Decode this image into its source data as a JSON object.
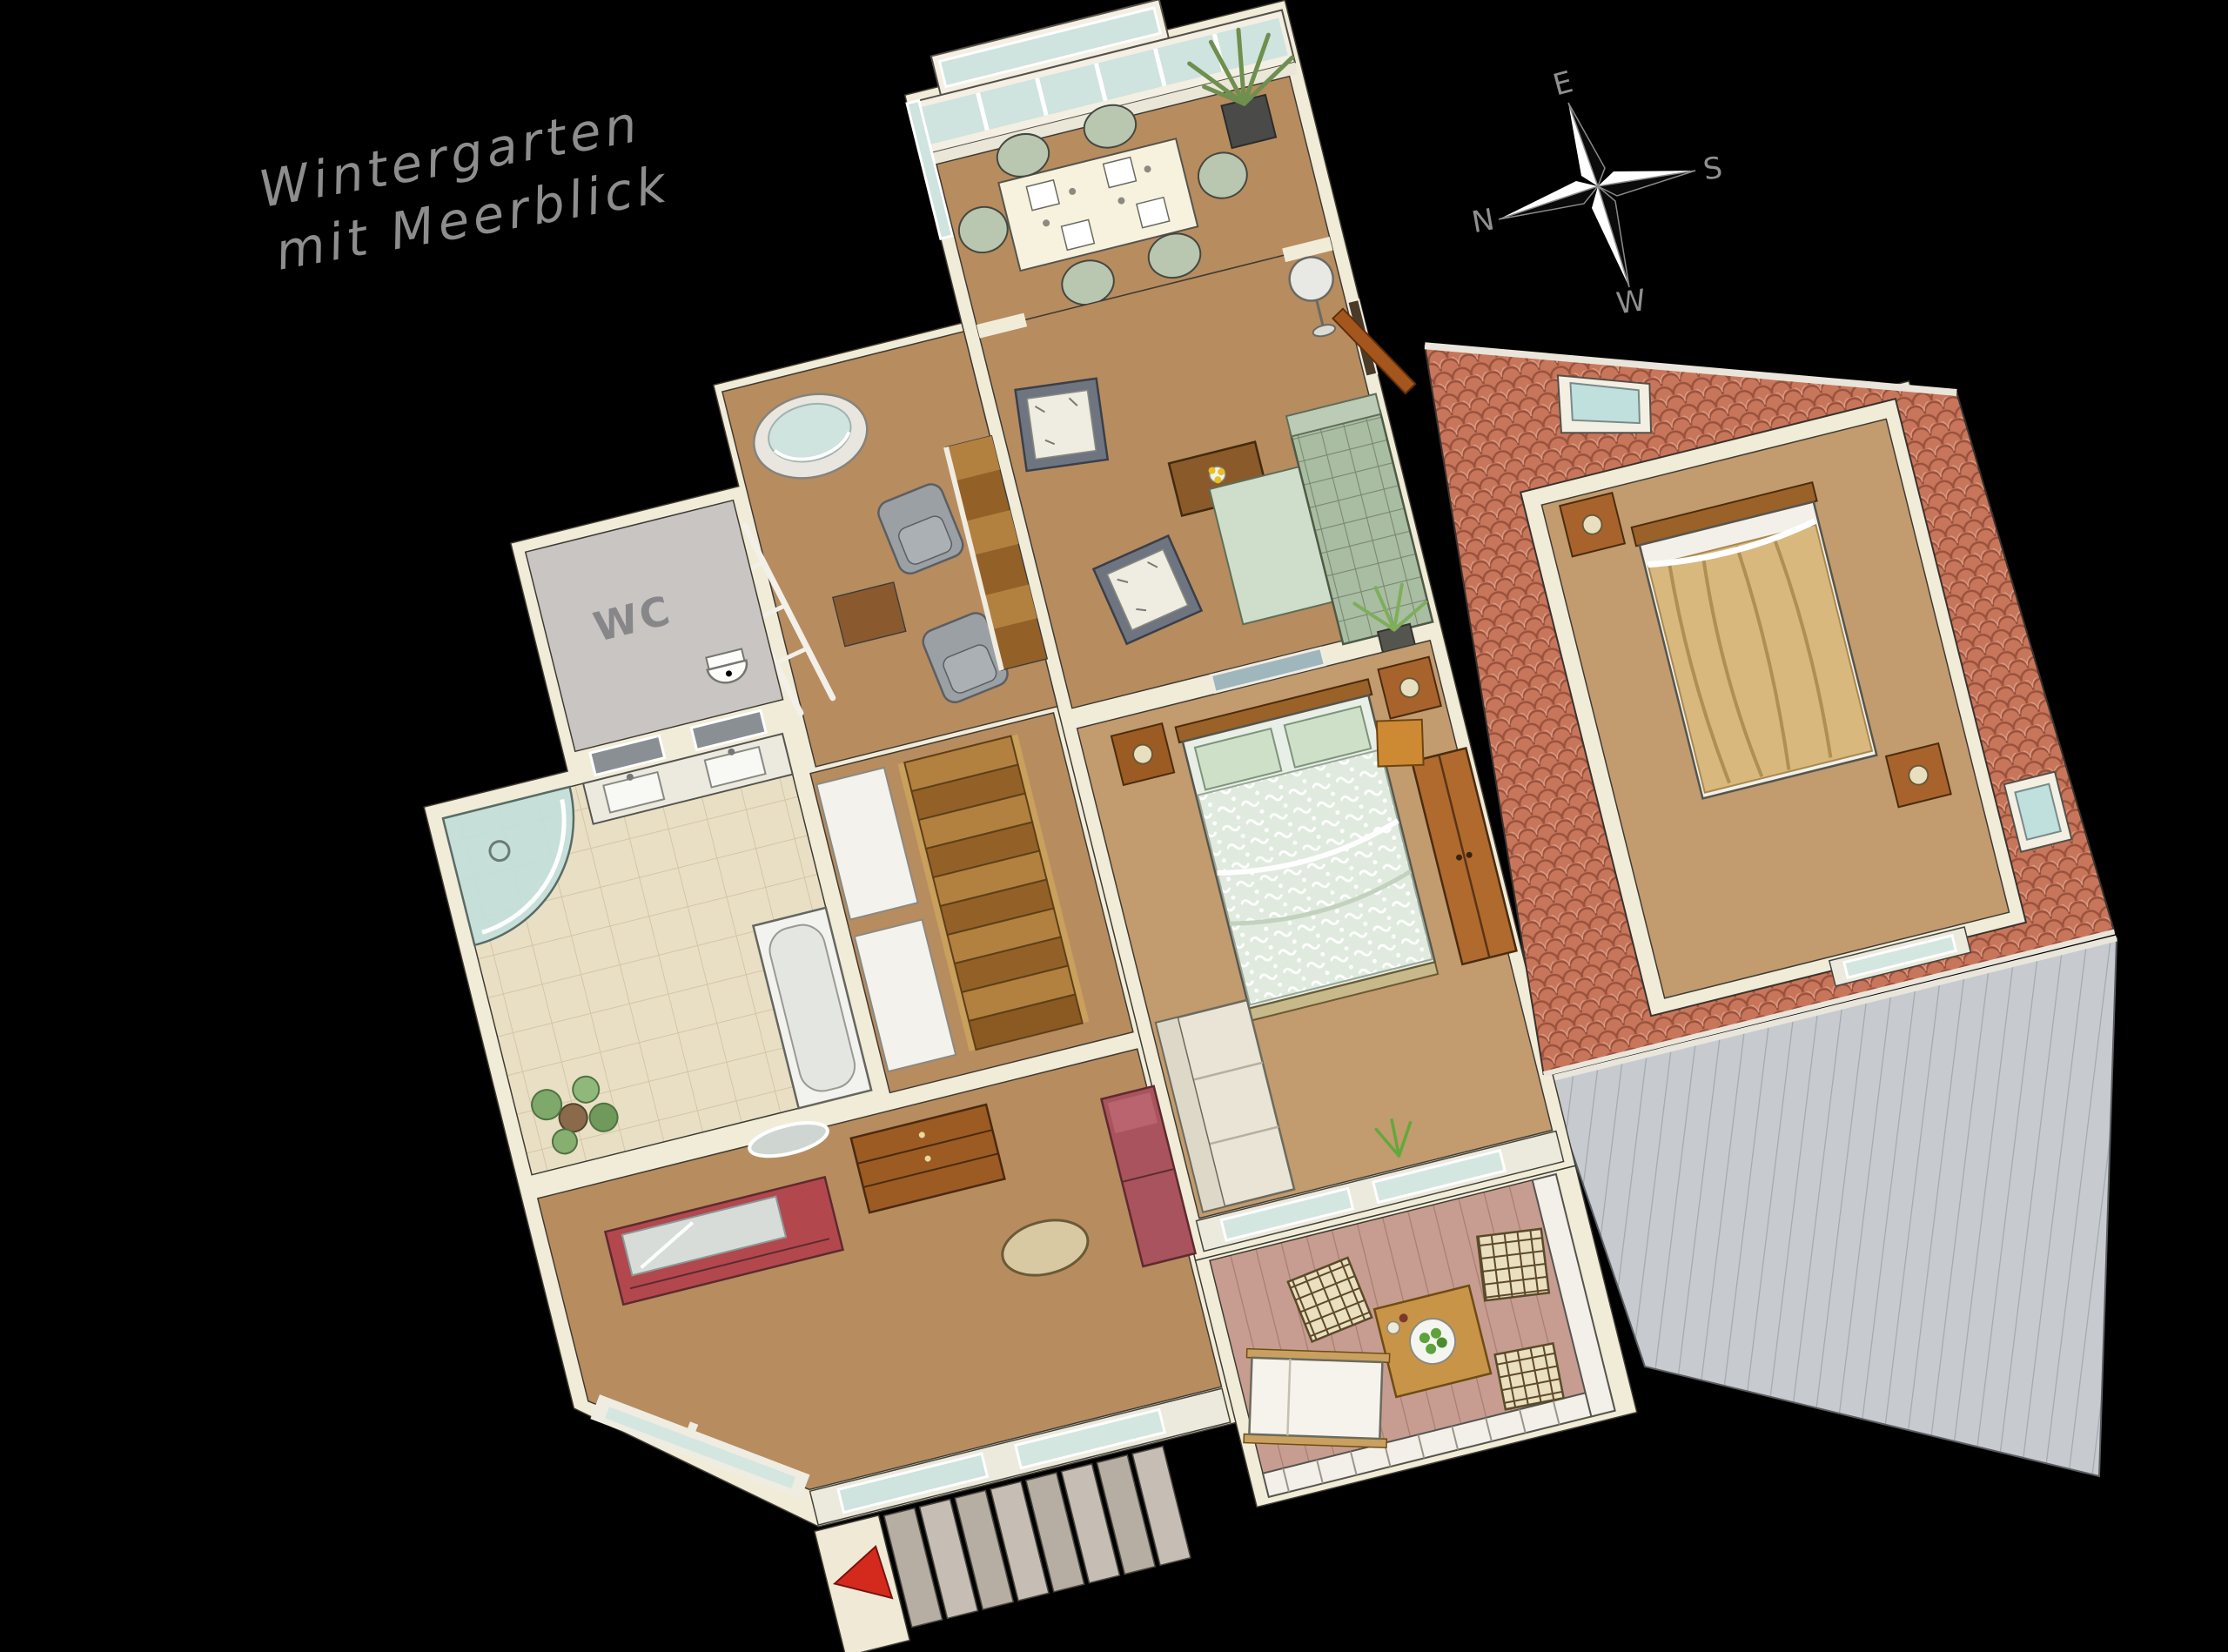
{
  "scene": {
    "background": "#000000"
  },
  "annotation": {
    "line1": "Wintergarten",
    "line2": "mit Meerblick",
    "color": "#8d8d8d"
  },
  "compass": {
    "east": "E",
    "south": "S",
    "north": "N",
    "west": "W",
    "letter_color": "#8f8f8f"
  },
  "floorplan": {
    "wc_label": "WC"
  },
  "palette": {
    "wall_cream": "#f1ecd8",
    "floor_wood": "#b78c5f",
    "floor_wood_light": "#c29b6e",
    "tile_base": "#e9dfc5",
    "wc_floor": "#c8c5c2",
    "roof_base": "#c8765b",
    "gable_base": "#c7cbcf",
    "glass": "#cfe3df",
    "deck": "#c69d90",
    "sofa_green": "#a9bda2",
    "sofa_chaise": "#cfdecb",
    "duvet": "#e0eade",
    "blanket_tan": "#d9b87e",
    "accent_red": "#d42a1e",
    "sofa_red": "#a8535d",
    "sideboard_red": "#b2484e",
    "wood_furniture": "#9c5b22",
    "stair_wood": "#b2813f",
    "white_sofa": "#e9e4d5",
    "step_gray": "#b6ada3"
  }
}
